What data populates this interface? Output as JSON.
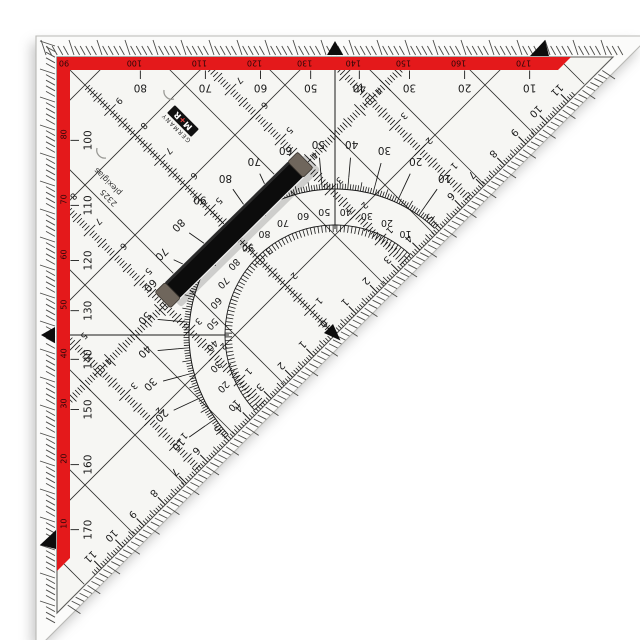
{
  "product": {
    "brand_logo": "M+R",
    "origin_label": "GERMANY",
    "material_label": "plexiglas",
    "model_number": "2325"
  },
  "colors": {
    "body": "#f6f6f3",
    "bevel": "#fbfbfa",
    "red_stripe": "#e4191b",
    "ink": "#1a1a1a",
    "stripe_text": "#2a0708",
    "cap_gray": "#6f665c",
    "handle_black": "#0c0c0c"
  },
  "hyp_ruler": {
    "unit": "cm",
    "labels": [
      "0",
      "1",
      "2",
      "3",
      "4",
      "5",
      "6",
      "7",
      "8",
      "9",
      "10",
      "11"
    ]
  },
  "altitude_ruler": {
    "cm_labels": [
      "1",
      "2",
      "3",
      "4",
      "5",
      "6",
      "7",
      "8",
      "9",
      "10"
    ]
  },
  "parallel_scales": {
    "offsets_cm": [
      4,
      7.6
    ],
    "cm_labels": [
      "1",
      "2",
      "3",
      "4",
      "5",
      "6",
      "7",
      "8"
    ]
  },
  "protractor": {
    "degree_step": 10,
    "outer_ring": [
      "10",
      "20",
      "30",
      "40",
      "50",
      "60",
      "70",
      "80",
      "90",
      "80",
      "70",
      "60",
      "50",
      "40",
      "30",
      "20",
      "10"
    ],
    "inner_ring": [
      "10",
      "20",
      "30",
      "40",
      "50",
      "60",
      "70",
      "80",
      "90",
      "80",
      "70",
      "60",
      "50",
      "40",
      "30",
      "20",
      "10"
    ]
  },
  "edge_scales": {
    "top_inner": [
      "10",
      "20",
      "30",
      "40",
      "50",
      "60",
      "70",
      "80"
    ],
    "top_stripe": [
      "90",
      "100",
      "110",
      "120",
      "130",
      "140",
      "150",
      "160",
      "170"
    ],
    "left_inner": [
      "100",
      "110",
      "120",
      "130",
      "140",
      "150",
      "160",
      "170"
    ],
    "left_stripe": [
      "80",
      "70",
      "60",
      "50",
      "40",
      "30",
      "20",
      "10"
    ]
  },
  "markers": {
    "names": [
      "top-center-index",
      "top-right-end-index",
      "left-center-index",
      "left-bottom-end-index",
      "hyp-zero-index"
    ]
  }
}
